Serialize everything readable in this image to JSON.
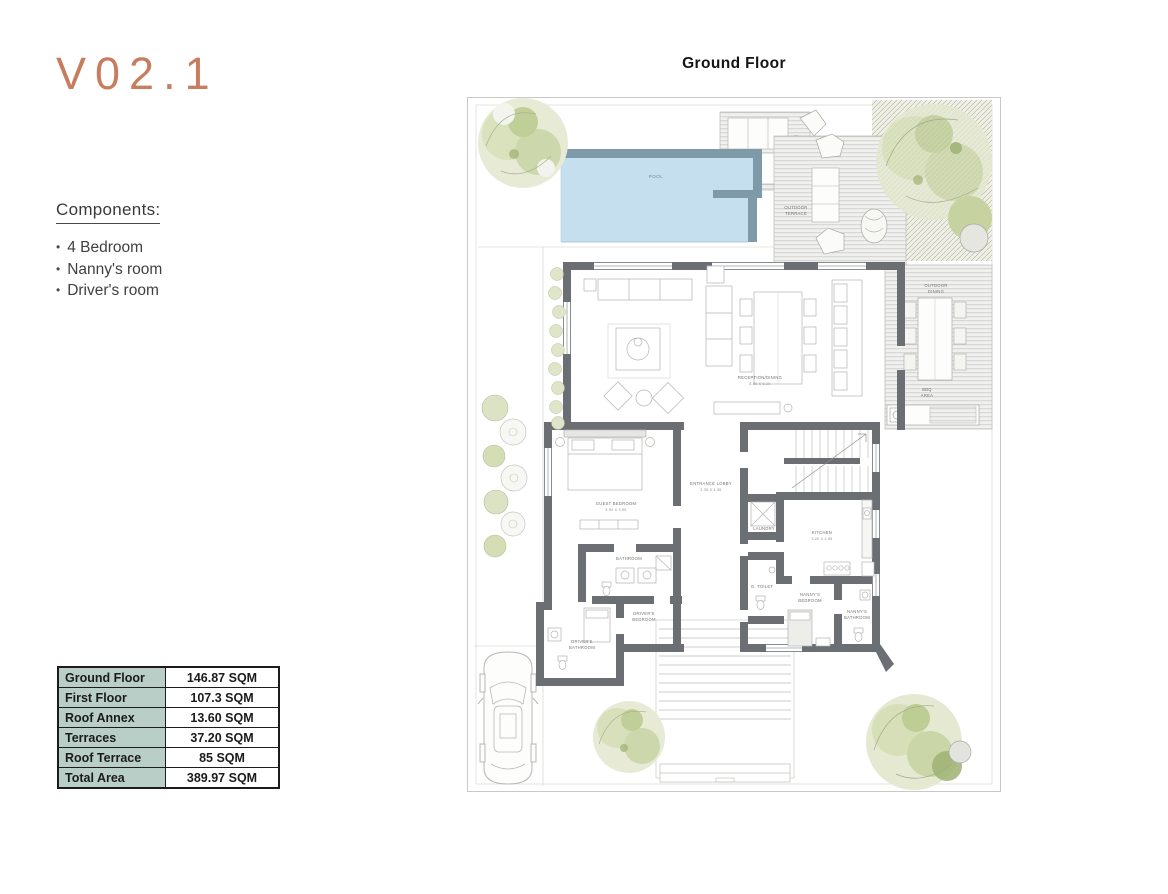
{
  "logo": {
    "text": "V02.1",
    "color": "#c77d5e"
  },
  "components": {
    "title": "Components:",
    "items": [
      "4 Bedroom",
      "Nanny's room",
      "Driver's room"
    ]
  },
  "area_table": {
    "header_bg": "#b8cec7",
    "rows": [
      {
        "label": "Ground Floor",
        "value": "146.87 SQM"
      },
      {
        "label": "First Floor",
        "value": "107.3 SQM"
      },
      {
        "label": "Roof Annex",
        "value": "13.60 SQM"
      },
      {
        "label": "Terraces",
        "value": "37.20 SQM"
      },
      {
        "label": "Roof Terrace",
        "value": "85 SQM"
      },
      {
        "label": "Total Area",
        "value": "389.97 SQM"
      }
    ]
  },
  "plan": {
    "title": "Ground Floor",
    "colors": {
      "pool_water": "#c5dfee",
      "pool_edge": "#7e9aa9",
      "wall": "#6b6f74"
    },
    "labels": {
      "pool": "POOL",
      "outdoor_terrace_1": "OUTDOOR",
      "outdoor_terrace_2": "TERRACE",
      "outdoor_dining_1": "OUTDOOR",
      "outdoor_dining_2": "DINING",
      "bbq_1": "BBQ",
      "bbq_2": "AREA",
      "reception": "RECEPTION/DINING",
      "reception_dim": "8.80 X 5.10",
      "guest_bedroom": "GUEST BEDROOM",
      "guest_bedroom_dim": "3.90 X 3.90",
      "entrance_lobby": "ENTRANCE LOBBY",
      "entrance_lobby_dim": "3.35 X 4.35",
      "bathroom": "BATHROOM",
      "laundry": "LAUNDRY",
      "kitchen": "KITCHEN",
      "kitchen_dim": "3.20 X 2.95",
      "g_toilet": "G. TOILET",
      "drivers_bedroom_1": "DRIVER'S",
      "drivers_bedroom_2": "BEDROOM",
      "drivers_bathroom_1": "DRIVER'S",
      "drivers_bathroom_2": "BATHROOM",
      "nannys_bedroom_1": "NANNY'S",
      "nannys_bedroom_2": "BEDROOM",
      "nannys_bathroom_1": "NANNY'S",
      "nannys_bathroom_2": "BATHROOM"
    }
  }
}
